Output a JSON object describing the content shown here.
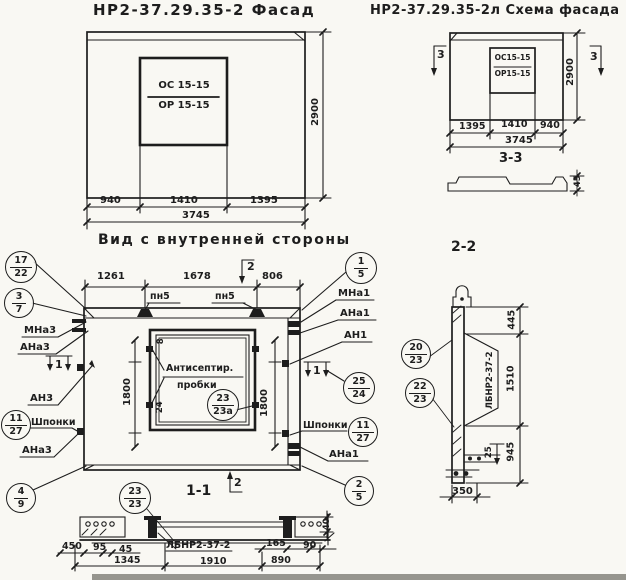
{
  "sheet": {
    "background": "#f9f8f3",
    "ink": "#1d1d1d"
  },
  "facade": {
    "title": "НР2-37.29.35-2 Фасад",
    "window_top": "ОС 15-15",
    "window_bottom": "ОР 15-15",
    "dim_left": "940",
    "dim_mid": "1410",
    "dim_right": "1395",
    "dim_total": "3745",
    "dim_height": "2900"
  },
  "schema": {
    "title": "НР2-37.29.35-2л  Схема фасада",
    "window_top": "ОС15-15",
    "window_bottom": "ОР15-15",
    "dim_left": "1395",
    "dim_mid": "1410",
    "dim_right": "940",
    "dim_total": "3745",
    "dim_height": "2900",
    "marker": "3",
    "section_title": "3-3",
    "profile_dim": "45"
  },
  "inner": {
    "title": "Вид с внутренней стороны",
    "dim1": "1261",
    "dim2": "1678",
    "dim3": "806",
    "dim_v_left": "1800",
    "dim_v_right": "1800",
    "plug_dim_top": "8",
    "plug_dim_bottom": "24",
    "pn5": "пн5",
    "note_line1": "Антисептир.",
    "note_line2": "пробки",
    "shponki": "Шпонки",
    "labels_left": {
      "mna3": "МНа3",
      "ana3": "АНа3",
      "an3": "АН3",
      "ana3_b": "АНа3"
    },
    "labels_right": {
      "mna1": "МНа1",
      "ana1": "АНа1",
      "an1": "АН1",
      "ana1_b": "АНа1"
    },
    "marker1": "1",
    "marker2": "2"
  },
  "section11": {
    "title": "1-1",
    "beam_label": "ЛБНР2-37-2",
    "d450": "450",
    "d95": "95",
    "d45": "45",
    "d1345": "1345",
    "d1910": "1910",
    "d165": "165",
    "d890": "890",
    "d90": "90",
    "d40": "40"
  },
  "section22": {
    "title": "2-2",
    "beam_label": "ЛБНР2-37-2",
    "d445": "445",
    "d1510": "1510",
    "d945": "945",
    "d25": "25",
    "d350": "350"
  },
  "balloons": {
    "b17_22": {
      "top": "17",
      "bottom": "22"
    },
    "b3_7": {
      "top": "3",
      "bottom": "7"
    },
    "b11_27_left": {
      "top": "11",
      "bottom": "27"
    },
    "b4_9": {
      "top": "4",
      "bottom": "9"
    },
    "b1_5": {
      "top": "1",
      "bottom": "5"
    },
    "b25_24": {
      "top": "25",
      "bottom": "24"
    },
    "b11_27_right": {
      "top": "11",
      "bottom": "27"
    },
    "b2_5": {
      "top": "2",
      "bottom": "5"
    },
    "b23_23a": {
      "top": "23",
      "bottom": "23а"
    },
    "b23_23": {
      "top": "23",
      "bottom": "23"
    },
    "b20_23": {
      "top": "20",
      "bottom": "23"
    },
    "b22_23": {
      "top": "22",
      "bottom": "23"
    }
  }
}
